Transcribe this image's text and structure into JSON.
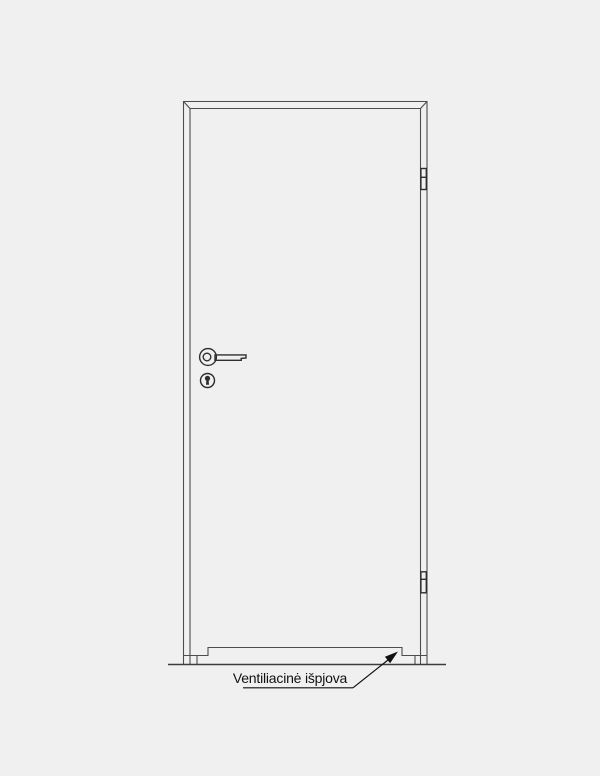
{
  "annotation": {
    "label": "Ventiliacinė išpjova"
  },
  "colors": {
    "background": "#f0f0f0",
    "frame_line": "#4d4d4d",
    "hardware_line": "#2e2e2e",
    "floor_line": "#3d3d3d",
    "annotation": "#111111"
  },
  "diagram": {
    "type": "door-elevation-line-drawing",
    "parts": [
      "door-frame",
      "door-leaf",
      "lever-handle",
      "keyhole",
      "hinge-top",
      "hinge-bottom",
      "ventilation-cutout",
      "floor-line",
      "leader-arrow"
    ]
  }
}
